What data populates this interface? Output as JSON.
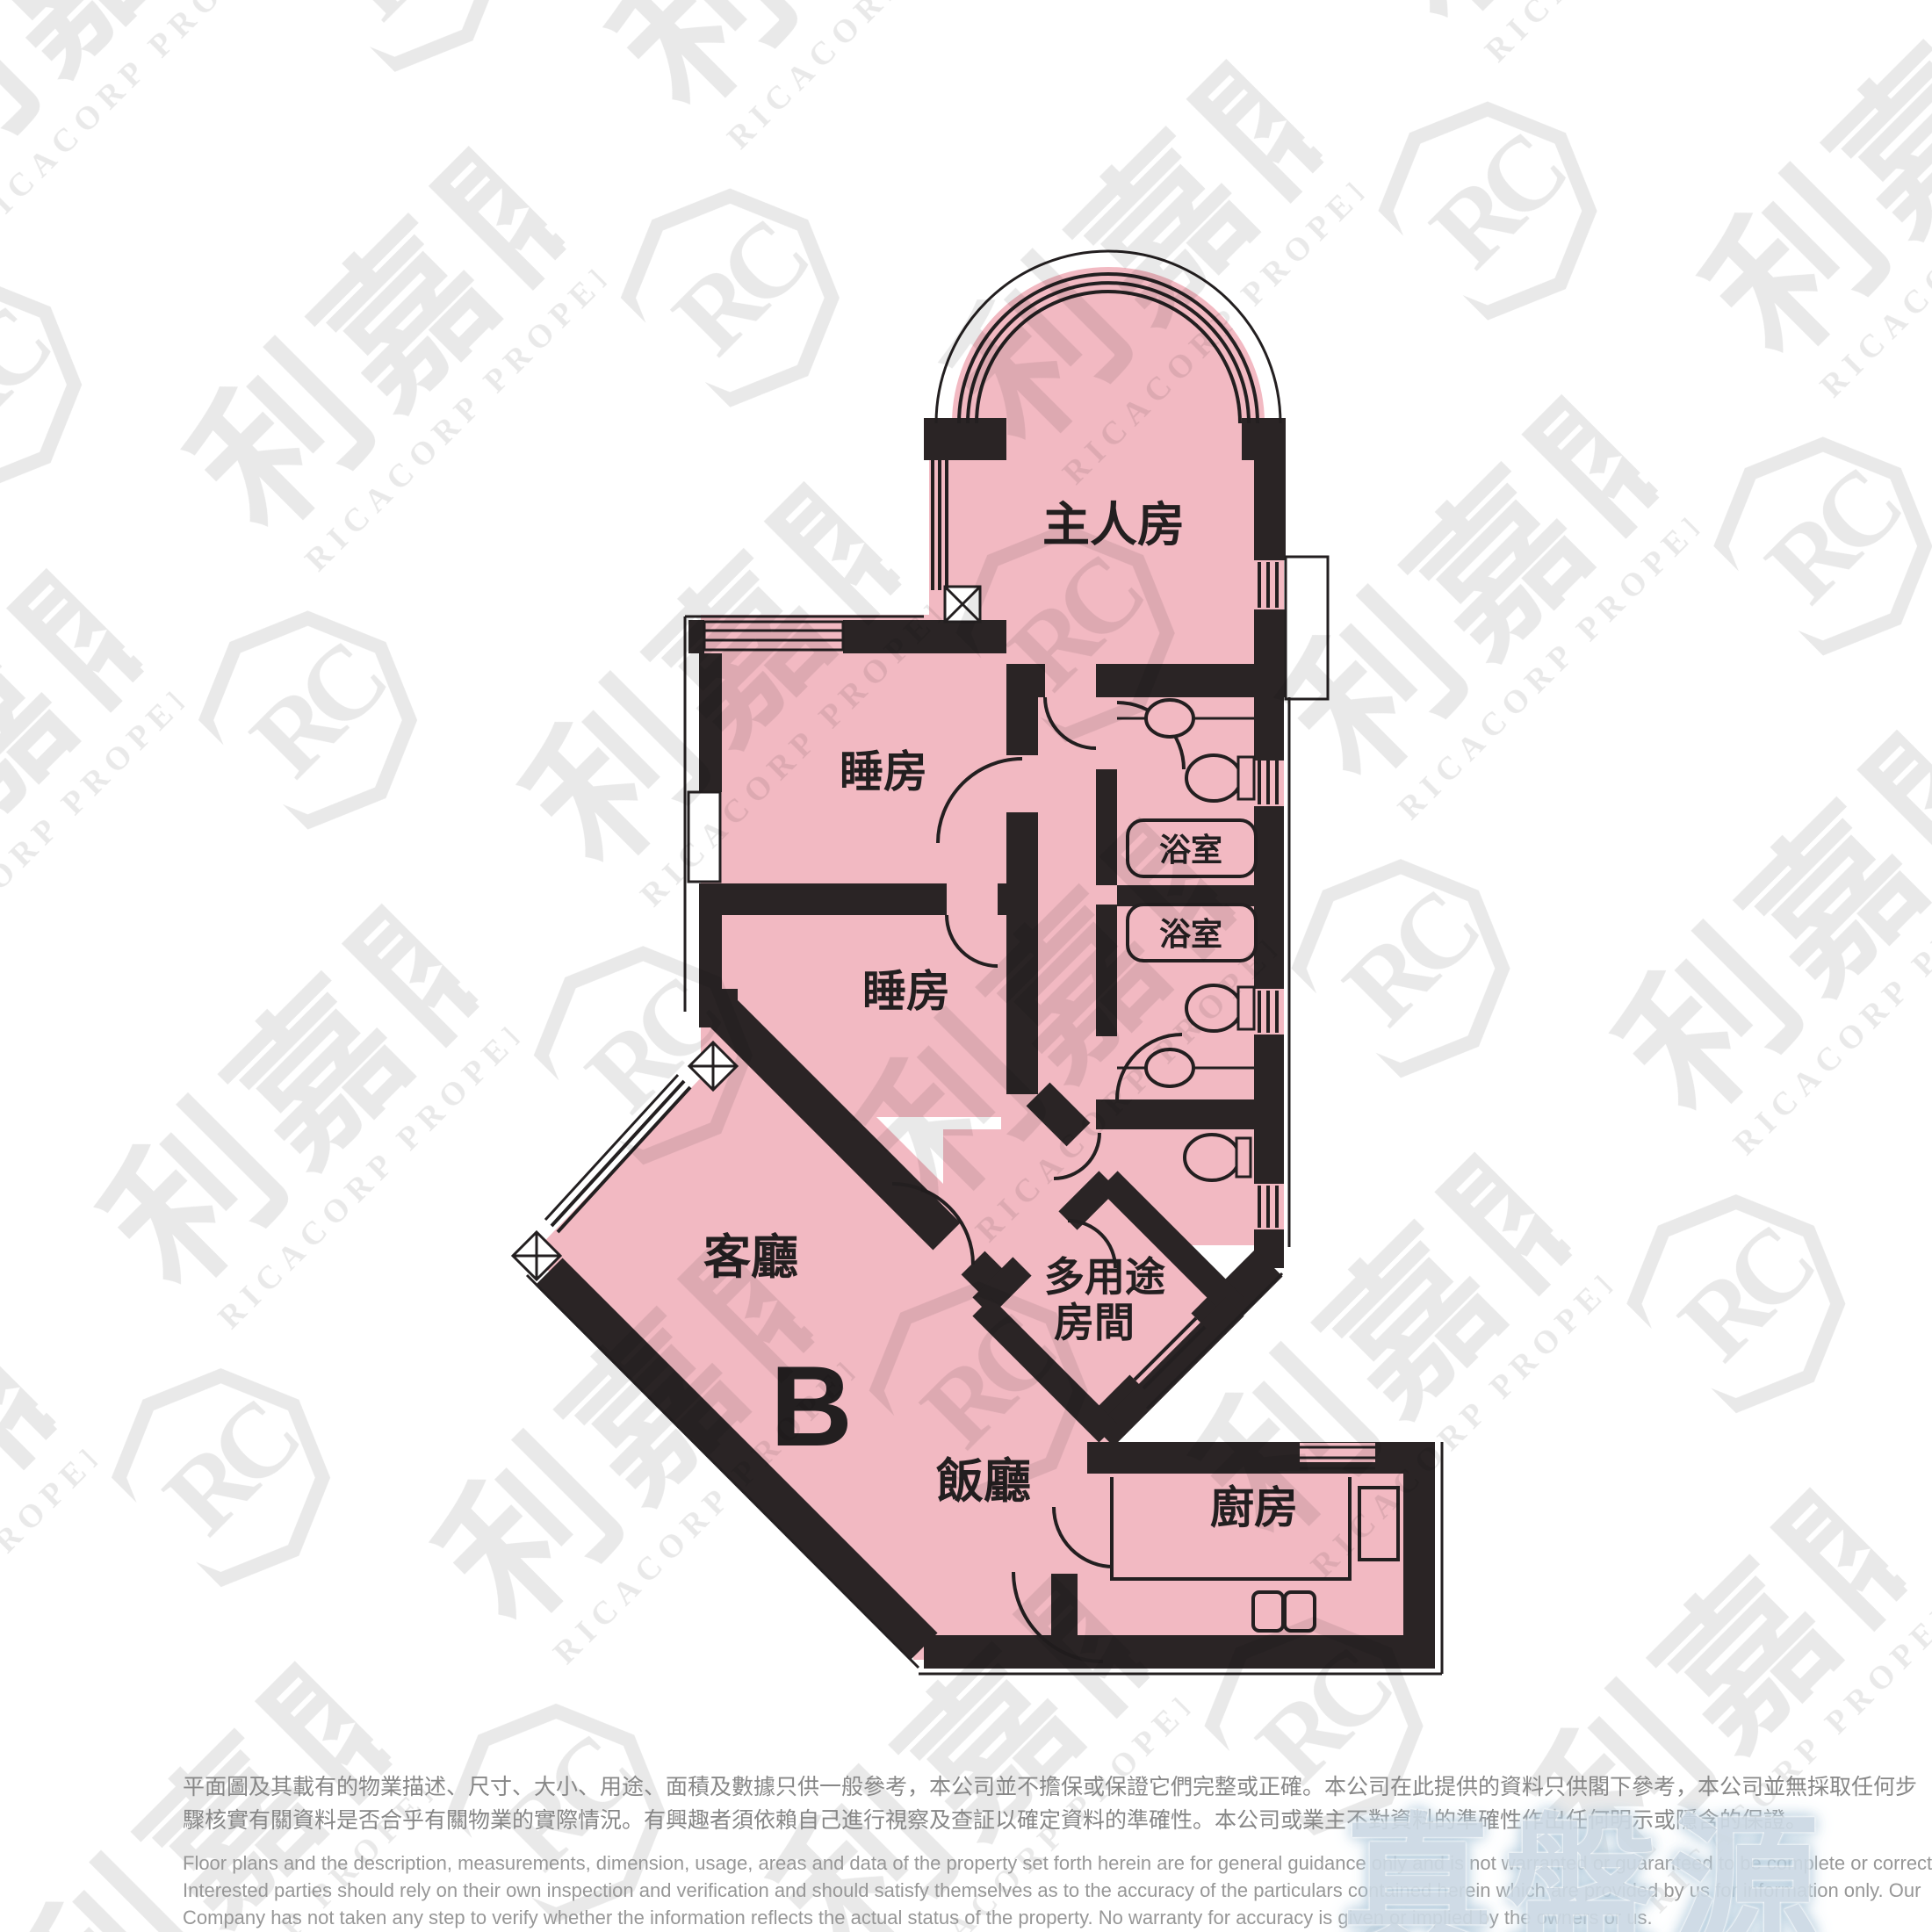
{
  "colors": {
    "plan_pink": "#F2B9C2",
    "wall_black": "#2A2425",
    "line_black": "#231F20",
    "brand_blue": "#CCD9E4",
    "disclaimer_gray": "#8B8B8B"
  },
  "floor_plan": {
    "unit_label": "B",
    "rooms": {
      "master_bedroom": "主人房",
      "bedroom_upper": "睡房",
      "bedroom_lower": "睡房",
      "bathroom_upper": "浴室",
      "bathroom_lower": "浴室",
      "living_room": "客廳",
      "dining_room": "飯廳",
      "multipurpose_line1": "多用途",
      "multipurpose_line2": "房間",
      "kitchen": "廚房"
    }
  },
  "watermark": {
    "cjk": "利嘉閣",
    "latin": "RICACORP PROPERTIES",
    "monogram": "RC"
  },
  "brand_logo": {
    "text": "真盤源"
  },
  "disclaimer": {
    "zh_lines": [
      "平面圖及其載有的物業描述、尺寸、大小、用途、面積及數據只供一般參考，本公司並不擔保或保證它們完整或正確。本公司在此提供的資料只供閣下參考，本公司並無採取任何步",
      "驟核實有關資料是否合乎有關物業的實際情況。有興趣者須依賴自己進行視察及查証以確定資料的準確性。本公司或業主不對資料的準確性作出任何明示或隱含的保證。"
    ],
    "en_lines": [
      "Floor plans and the description, measurements, dimension, usage, areas and data of the property set forth herein are for general guidance only and is not warranted or guaranteed to be complete or correct.",
      "Interested parties should rely on their own inspection and verification and should satisfy themselves as to the accuracy of the particulars contained herein which are provided by us for information only.  Our",
      "Company has not taken any step to verify whether the information reflects the actual status of the property.  No warranty for accuracy is given or implied by the owners or us."
    ]
  }
}
